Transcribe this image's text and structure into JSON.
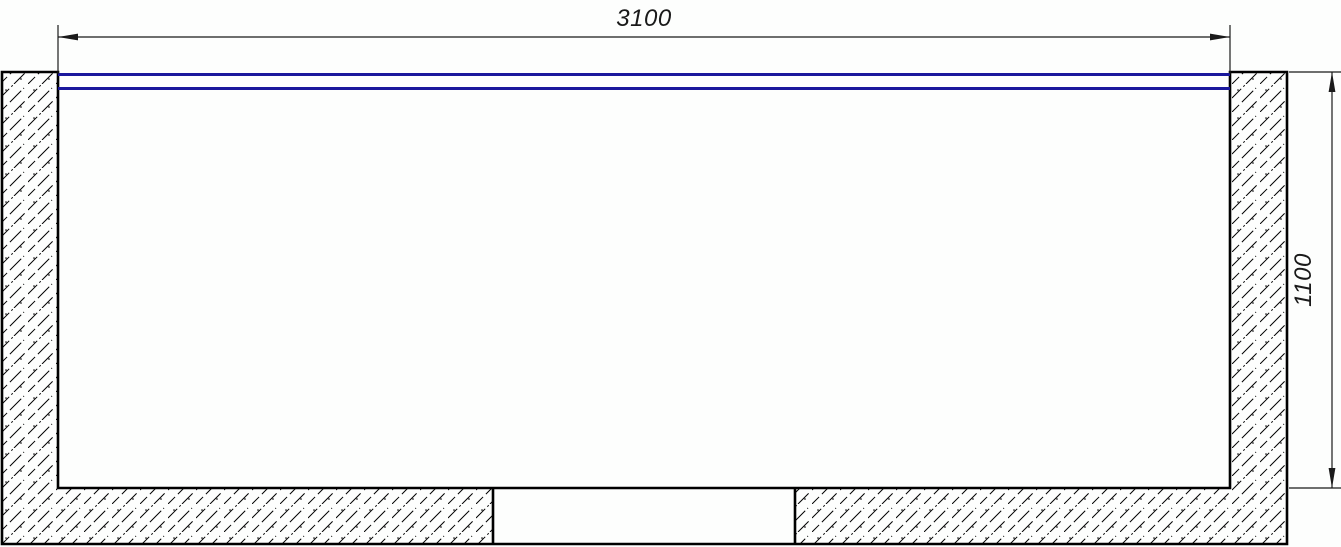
{
  "drawing": {
    "dimensions": {
      "horizontal": {
        "label": "3100"
      },
      "vertical": {
        "label": "1100"
      }
    },
    "colors": {
      "water_line": "#1a189c",
      "outline": "#000000",
      "dim_line": "#1a1a1a",
      "background": "#fdfefd"
    }
  }
}
